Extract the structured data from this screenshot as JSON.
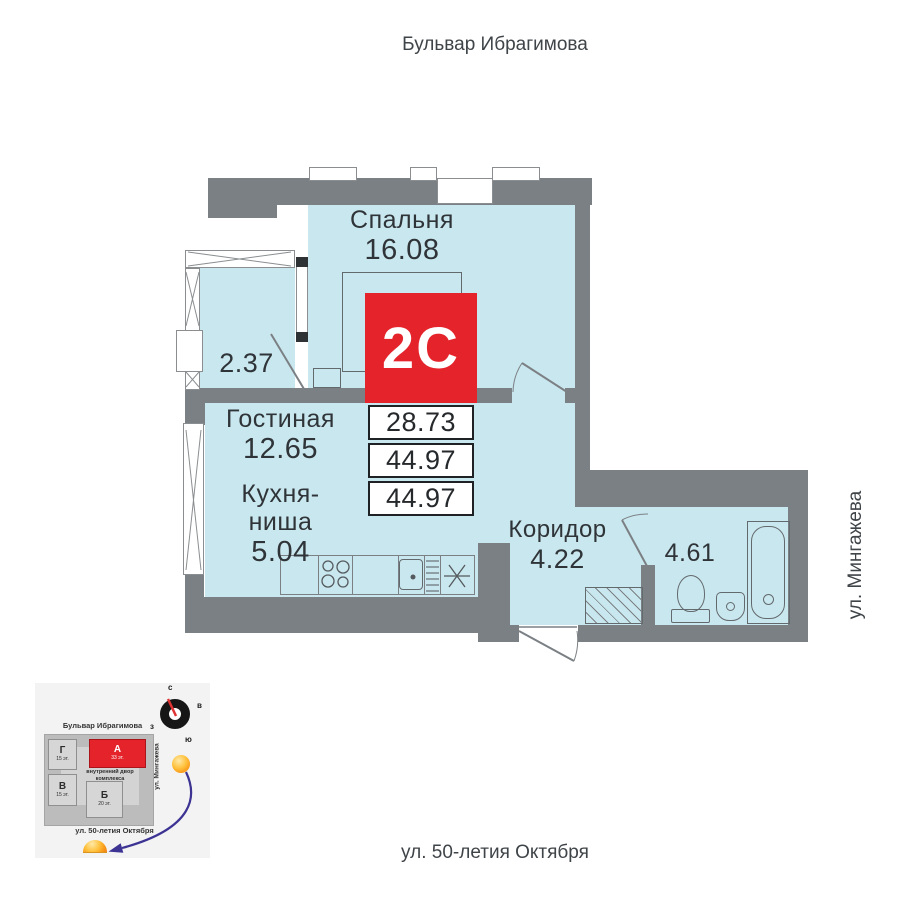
{
  "streets": {
    "top": "Бульвар Ибрагимова",
    "right": "ул. Мингажева",
    "bottom": "ул. 50-летия Октября"
  },
  "plan": {
    "rooms": {
      "bedroom": {
        "name": "Спальня",
        "area": "16.08"
      },
      "balcony": {
        "area": "2.37"
      },
      "living": {
        "name": "Гостиная",
        "area": "12.65"
      },
      "kitchen": {
        "name": "Кухня-\nниша",
        "area": "5.04"
      },
      "corridor": {
        "name": "Коридор",
        "area": "4.22"
      },
      "bathroom": {
        "area": "4.61"
      }
    },
    "badge": {
      "type_label": "2С",
      "living_area": "28.73",
      "area_no_balcony": "44.97",
      "total_area": "44.97"
    },
    "colors": {
      "room_fill": "#c9e7ee",
      "wall": "#7b8084",
      "accent": "#e4232b"
    }
  },
  "minimap": {
    "street_top": "Бульвар Ибрагимова",
    "street_right": "ул. Мингажева",
    "street_bottom": "ул. 50-летия Октября",
    "courtyard_label": "внутренний двор комплекса",
    "buildings": [
      {
        "label": "Г",
        "floors": "15 эт."
      },
      {
        "label": "В",
        "floors": "15 эт."
      },
      {
        "label": "А",
        "floors": "33 эт.",
        "highlighted": true
      },
      {
        "label": "Б",
        "floors": "20 эт."
      }
    ],
    "compass": {
      "north": "с",
      "east": "в",
      "west": "з",
      "south": "ю"
    }
  }
}
